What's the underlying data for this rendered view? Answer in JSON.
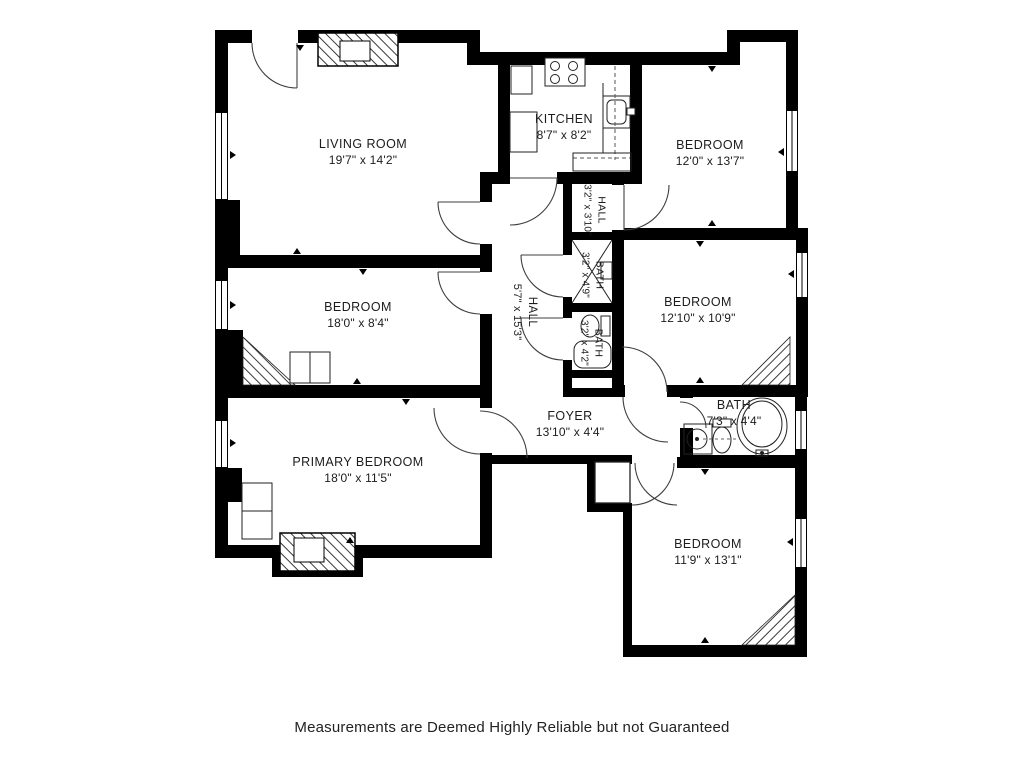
{
  "plan": {
    "footer": "Measurements are Deemed Highly Reliable but not Guaranteed",
    "colors": {
      "wall": "#000000",
      "floor": "#ffffff",
      "label_text": "#1c1c1c"
    },
    "rooms": [
      {
        "id": "living-room",
        "name": "LIVING ROOM",
        "dims": "19'7\" x 14'2\""
      },
      {
        "id": "kitchen",
        "name": "KITCHEN",
        "dims": "8'7\" x 8'2\""
      },
      {
        "id": "bedroom-top-right",
        "name": "BEDROOM",
        "dims": "12'0\" x 13'7\""
      },
      {
        "id": "hall-small",
        "name": "HALL",
        "dims": "3'2\" x 3'10\""
      },
      {
        "id": "bath-small-top",
        "name": "BATH",
        "dims": "3'2\" x 4'9\""
      },
      {
        "id": "bath-small-bottom",
        "name": "BATH",
        "dims": "3'2\" x 4'2\""
      },
      {
        "id": "hall-main",
        "name": "HALL",
        "dims": "5'7\" x 15'3\""
      },
      {
        "id": "bedroom-mid-left",
        "name": "BEDROOM",
        "dims": "18'0\" x 8'4\""
      },
      {
        "id": "bedroom-mid-right",
        "name": "BEDROOM",
        "dims": "12'10\" x 10'9\""
      },
      {
        "id": "primary-bedroom",
        "name": "PRIMARY BEDROOM",
        "dims": "18'0\" x 11'5\""
      },
      {
        "id": "foyer",
        "name": "FOYER",
        "dims": "13'10\" x 4'4\""
      },
      {
        "id": "bath-main",
        "name": "BATH",
        "dims": "7'3\" x 4'4\""
      },
      {
        "id": "bedroom-bottom",
        "name": "BEDROOM",
        "dims": "11'9\" x 13'1\""
      }
    ]
  }
}
